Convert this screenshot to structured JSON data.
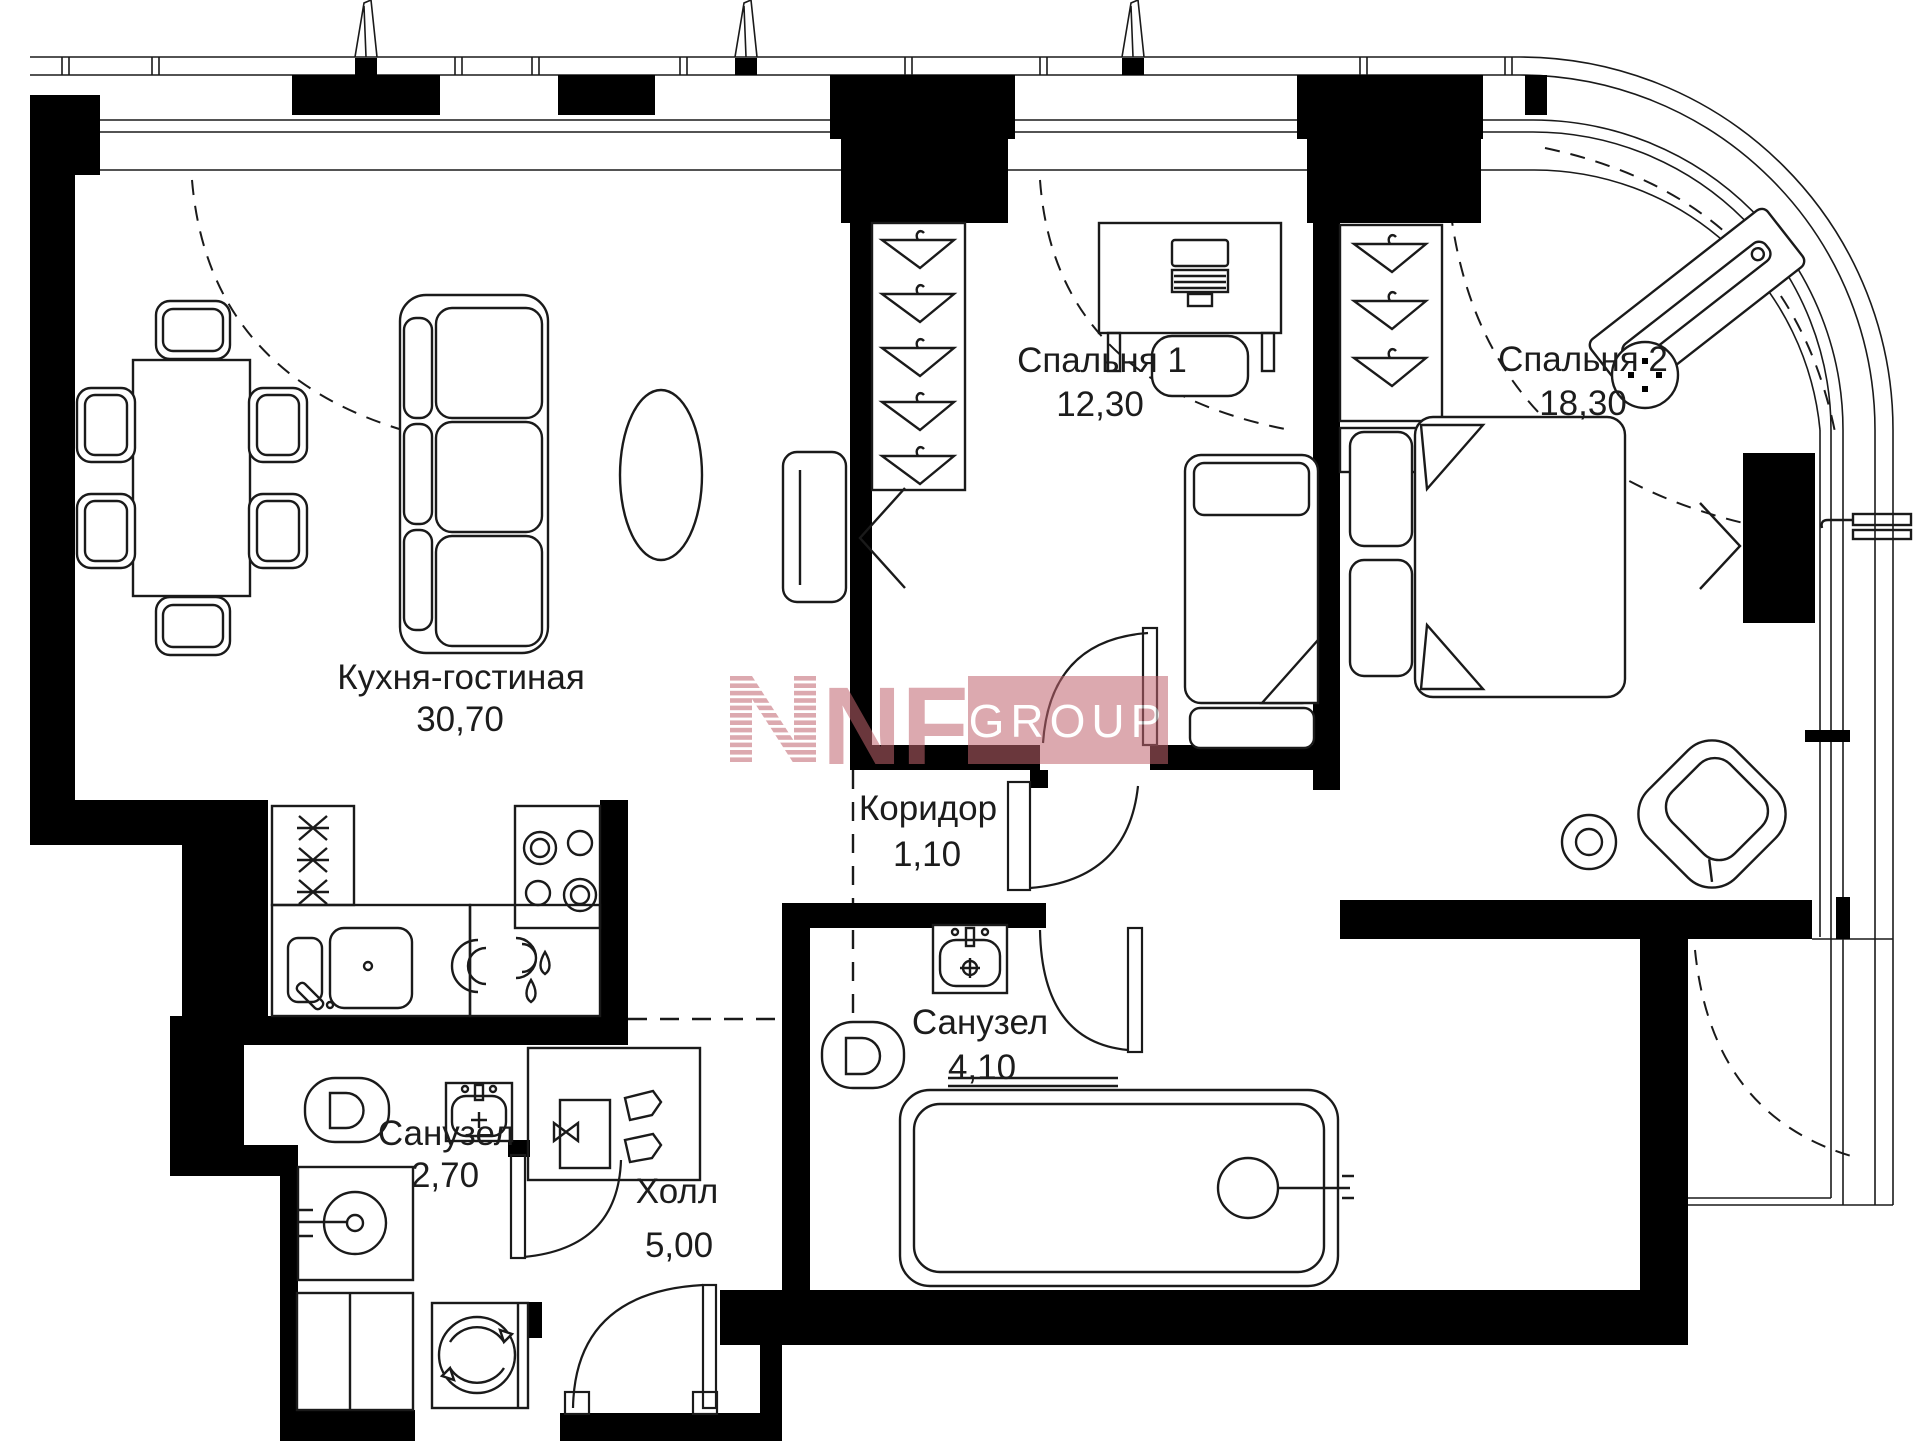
{
  "plan": {
    "rooms": [
      {
        "id": "kitchen-living",
        "name": "Кухня-гостиная",
        "area": "30,70"
      },
      {
        "id": "bedroom-1",
        "name": "Спальня 1",
        "area": "12,30"
      },
      {
        "id": "bedroom-2",
        "name": "Спальня 2",
        "area": "18,30"
      },
      {
        "id": "corridor",
        "name": "Коридор",
        "area": "1,10"
      },
      {
        "id": "bathroom-main",
        "name": "Санузел",
        "area": "4,10"
      },
      {
        "id": "bathroom-guest",
        "name": "Санузел",
        "area": "2,70"
      },
      {
        "id": "hall",
        "name": "Холл",
        "area": "5,00"
      }
    ],
    "colors": {
      "wall": "#000000",
      "line": "#1a1a1a",
      "paper": "#ffffff",
      "watermark": "#c1646e"
    }
  },
  "watermark": {
    "brand": "NF",
    "suffix": "GROUP"
  }
}
